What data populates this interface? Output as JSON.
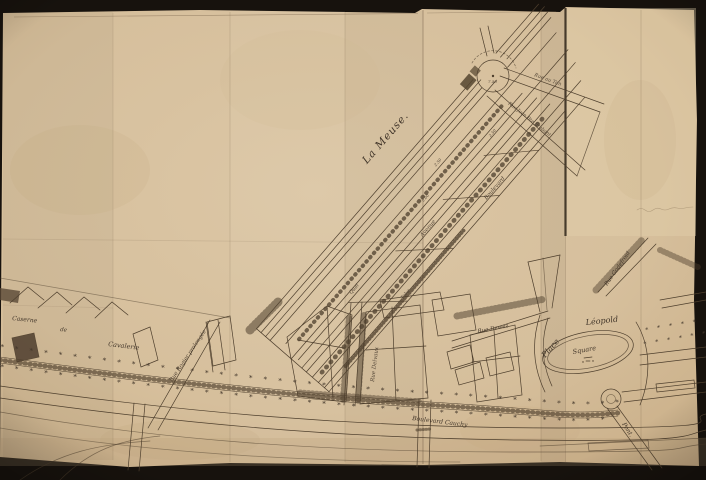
{
  "map": {
    "labels": {
      "river": "La Meuse.",
      "place_word": "Place",
      "place_name": "Léopold",
      "square": "Square",
      "rue_dewez": "Rue Dewez",
      "rue_godefroid": "Rue Godefroid",
      "rue_delvaux": "Rue Delvaux",
      "rue_rogier": "Rue Rogier prolongée",
      "boulevard_cauchy": "Boulevard Cauchy",
      "caserne_word1": "Caserne",
      "caserne_word2": "de",
      "caserne_word3": "Cavalerie",
      "rue_au_tan": "Rue au Tan",
      "rue_jean_brabant": "Rue Jean Bte Brabant",
      "pont": "Pont.",
      "band_word1": "Quai",
      "band_word2": "Avenue",
      "band_word3": "Boulevard",
      "band_word4": "Talus",
      "dim_a": "2.50",
      "dim_b": "5.00",
      "dim_c": "2.50",
      "circle_dim": "7.50"
    },
    "decor": {
      "tree_row": "* * * * * * * * * * * * * * * * * * * * * * * * * * * * * * * * * * * * * * * * * * * * * * * * * * * *",
      "tree_row_b": "* * * * * * * * * * * * * * * * * * * * * * * * * * * * * * * * * * * * * * * * * * * * * * * *",
      "tree_row_short": "* * * * * * * *",
      "tree_row_short_b": "* * * * * * * *"
    },
    "colors": {
      "background": "#17120d",
      "paper": "#d8c19e",
      "ink": "#4e3f2d"
    }
  }
}
